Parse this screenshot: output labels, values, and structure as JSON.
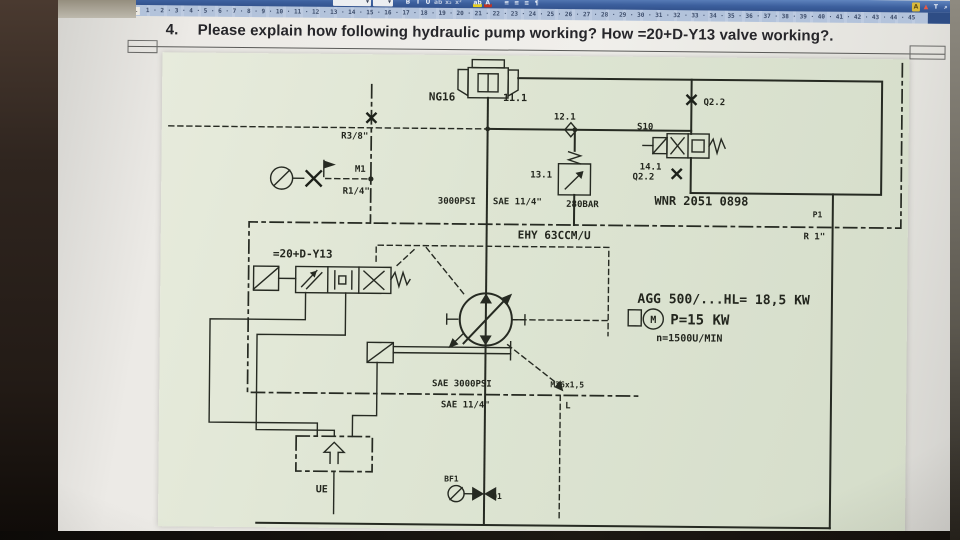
{
  "window": {
    "toolbar": {
      "icons": [
        {
          "name": "font-name-box",
          "glyph": "▾"
        },
        {
          "name": "font-size-box",
          "glyph": "▾"
        },
        {
          "name": "bold",
          "glyph": "B"
        },
        {
          "name": "italic",
          "glyph": "I"
        },
        {
          "name": "underline",
          "glyph": "U"
        },
        {
          "name": "strikethrough",
          "glyph": "ab"
        },
        {
          "name": "subscript",
          "glyph": "x₂"
        },
        {
          "name": "superscript",
          "glyph": "x²"
        },
        {
          "name": "highlight",
          "glyph": "ab"
        },
        {
          "name": "font-color",
          "glyph": "A"
        },
        {
          "name": "align-left",
          "glyph": "≡"
        },
        {
          "name": "align-center",
          "glyph": "≡"
        },
        {
          "name": "align-right",
          "glyph": "≡"
        },
        {
          "name": "paragraph",
          "glyph": "¶"
        },
        {
          "name": "styles",
          "glyph": "A"
        },
        {
          "name": "change-case",
          "glyph": "▲"
        },
        {
          "name": "sort",
          "glyph": "T"
        },
        {
          "name": "find",
          "glyph": "⌕"
        }
      ]
    },
    "ruler": {
      "tab_marker": "L",
      "numbers": "1 · 2 · 3 · 4 · 5 · 6 · 7 · 8 · 9 · 10 · 11 · 12 · 13 · 14 · 15 · 16 · 17 · 18 · 19 · 20 · 21 · 22 · 23 · 24 · 25 · 26 · 27 · 28 · 29 · 30 · 31 · 32 · 33 · 34 · 35 · 36 · 37 · 38 · 39 · 40 · 41 · 42 · 43 · 44 · 45"
    }
  },
  "document": {
    "question_number": "4.",
    "question_text": "Please explain how following hydraulic pump working? How =20+D-Y13 valve working?."
  },
  "diagram": {
    "colors": {
      "paper": "#dee5d3",
      "ink": "#262a22"
    },
    "labels": {
      "ng16": "NG16",
      "v11": "11.1",
      "r38": "R3/8\"",
      "m1": "M1",
      "r14": "R1/4\"",
      "orifice": "12.1",
      "relief": "13.1",
      "relief_pressure": "280BAR",
      "s10": "S10",
      "v14": "14.1",
      "q22_top": "Q2.2",
      "q22_bottom": "Q2.2",
      "psi": "3000PSI",
      "sae_quarter_top": "SAE 11/4\"",
      "wnr": "WNR 2051 0898",
      "p1": "P1",
      "r1": "R 1\"",
      "ehy": "EHY 63CCM/U",
      "y13": "=20+D-Y13",
      "agg": "AGG 500/...HL= 18,5 KW",
      "power": "P=15 KW",
      "speed": "n=1500U/MIN",
      "motor": "M",
      "sae_3000": "SAE 3000PSI",
      "sae_quarter_bottom": "SAE 11/4\"",
      "m26": "M26x1,5",
      "l_port": "L",
      "ue": "UE",
      "bf1": "BF1",
      "q1": "Q1"
    }
  }
}
